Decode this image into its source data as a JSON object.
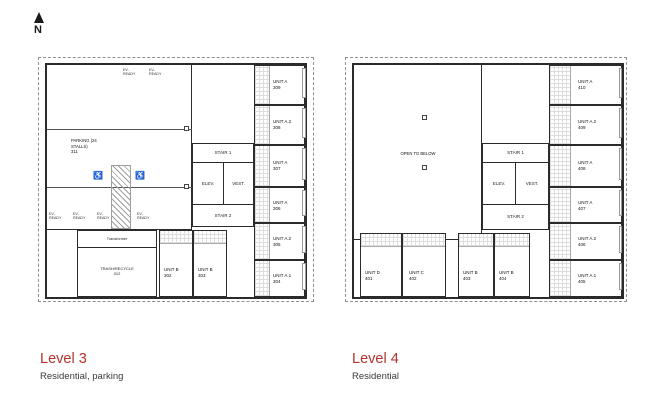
{
  "north": {
    "label": "N"
  },
  "colors": {
    "accent": "#b4322d",
    "wall": "#2b2b2b"
  },
  "level3": {
    "title": "Level 3",
    "subtitle": "Residential, parking",
    "parking": {
      "name": "PARKING (24\nSTALLS)",
      "number": "311"
    },
    "ev_label": "EV-\nREADY",
    "accessible_icon": "♿",
    "transformer": "Transformer",
    "trash": {
      "name": "TRASH/RECYCLE",
      "number": "312"
    },
    "core": {
      "stair1": "STAIR 1",
      "elev": "ELEV.",
      "vest": "VEST.",
      "stair2": "STAIR 2"
    },
    "units": [
      {
        "name": "UNIT A",
        "number": "309"
      },
      {
        "name": "UNIT A.2",
        "number": "308"
      },
      {
        "name": "UNIT A",
        "number": "307"
      },
      {
        "name": "UNIT A",
        "number": "306"
      },
      {
        "name": "UNIT A.2",
        "number": "305"
      },
      {
        "name": "UNIT A.1",
        "number": "304"
      },
      {
        "name": "UNIT B",
        "number": "302"
      },
      {
        "name": "UNIT B",
        "number": "303"
      }
    ]
  },
  "level4": {
    "title": "Level 4",
    "subtitle": "Residential",
    "open_area": "OPEN TO BELOW",
    "core": {
      "stair1": "STAIR 1",
      "elev": "ELEV.",
      "vest": "VEST.",
      "stair2": "STAIR 2"
    },
    "units": [
      {
        "name": "UNIT A",
        "number": "410"
      },
      {
        "name": "UNIT A.2",
        "number": "409"
      },
      {
        "name": "UNIT A",
        "number": "408"
      },
      {
        "name": "UNIT A",
        "number": "407"
      },
      {
        "name": "UNIT A.2",
        "number": "406"
      },
      {
        "name": "UNIT A.1",
        "number": "405"
      },
      {
        "name": "UNIT D",
        "number": "401"
      },
      {
        "name": "UNIT C",
        "number": "402"
      },
      {
        "name": "UNIT B",
        "number": "403"
      },
      {
        "name": "UNIT B",
        "number": "404"
      }
    ]
  }
}
